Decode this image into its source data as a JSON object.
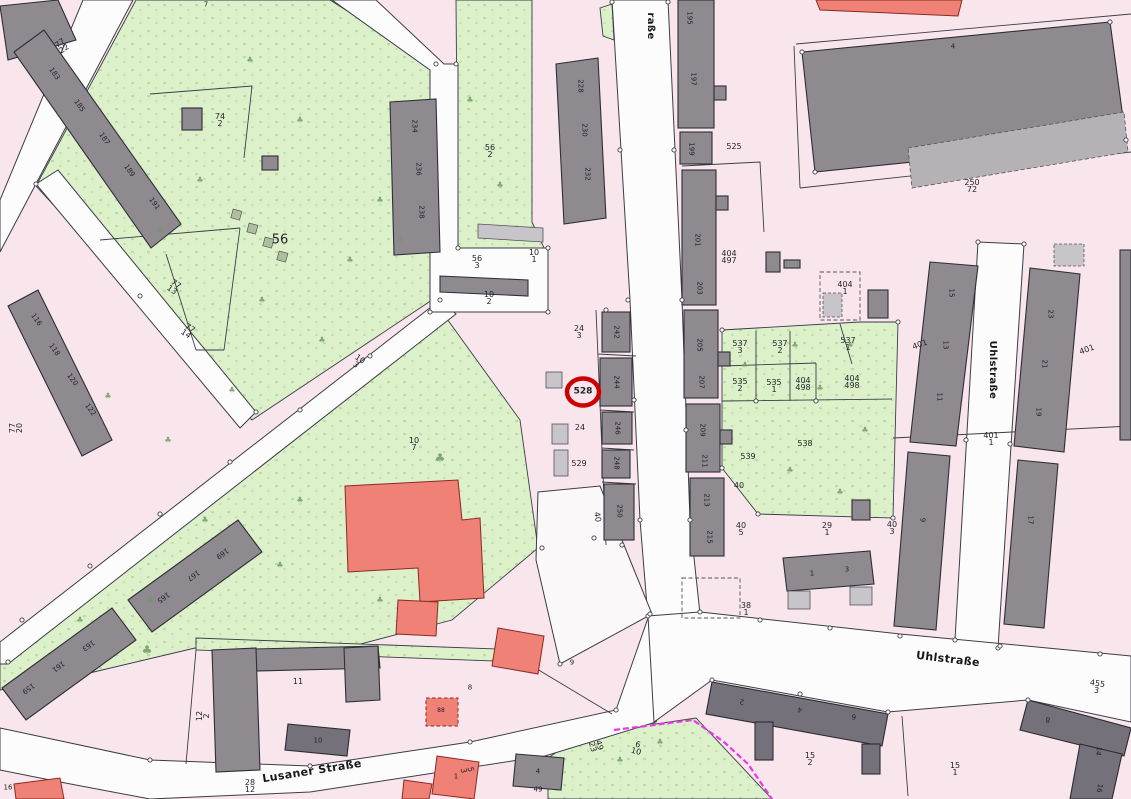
{
  "map": {
    "type": "cadastral-parcel-map",
    "highlighted_parcel": "528",
    "streets": [
      "Uhlstraße",
      "Lusaner Straße"
    ],
    "colors": {
      "parcel_pink": "#f8e6ec",
      "street_white": "#fdfcfd",
      "green_area": "#dcf0ca",
      "building_gray": "#8e8a90",
      "building_dark": "#75717a",
      "building_light": "#c7c4ca",
      "red_building": "#ef8177",
      "highlight_ring": "#cc0000",
      "boundary_magenta": "#e838e8",
      "boundary_line": "#3c3c46"
    },
    "labels": [
      {
        "t": "raße",
        "x": 650,
        "y": 26,
        "r": 90,
        "s": 10,
        "b": 1,
        "cls": "street-label"
      },
      {
        "t": "Uhlstraße",
        "x": 992,
        "y": 370,
        "r": 90,
        "s": 10,
        "b": 1,
        "cls": "street-label"
      },
      {
        "t": "Uhlstraße",
        "x": 948,
        "y": 659,
        "r": 7,
        "s": 11,
        "b": 1,
        "cls": "street-label"
      },
      {
        "t": "Lusaner Straße",
        "x": 312,
        "y": 771,
        "r": -9,
        "s": 11,
        "b": 1,
        "cls": "street-label"
      },
      {
        "t": "528",
        "x": 583,
        "y": 392,
        "s": 9,
        "b": 1,
        "cls": "highlighted-parcel-label"
      },
      {
        "t": "77/22",
        "x": 62,
        "y": 46,
        "r": -35
      },
      {
        "t": "74/2",
        "x": 220,
        "y": 120
      },
      {
        "t": "7",
        "x": 206,
        "y": 5,
        "s": 7
      },
      {
        "t": "56",
        "x": 280,
        "y": 240,
        "s": 13
      },
      {
        "t": "77/13",
        "x": 174,
        "y": 287,
        "r": 35
      },
      {
        "t": "77/14",
        "x": 188,
        "y": 331,
        "r": 35
      },
      {
        "t": "77/20",
        "x": 16,
        "y": 428,
        "r": -90
      },
      {
        "t": "10/3",
        "x": 358,
        "y": 362,
        "r": 35
      },
      {
        "t": "10/7",
        "x": 414,
        "y": 444
      },
      {
        "t": "56/2",
        "x": 490,
        "y": 151
      },
      {
        "t": "56/3",
        "x": 477,
        "y": 262
      },
      {
        "t": "10/1",
        "x": 534,
        "y": 256
      },
      {
        "t": "10/2",
        "x": 489,
        "y": 298
      },
      {
        "t": "24/3",
        "x": 579,
        "y": 332
      },
      {
        "t": "24",
        "x": 580,
        "y": 428
      },
      {
        "t": "529",
        "x": 579,
        "y": 464
      },
      {
        "t": "40",
        "x": 597,
        "y": 517,
        "r": 80
      },
      {
        "t": "525",
        "x": 734,
        "y": 147
      },
      {
        "t": "404/497",
        "x": 729,
        "y": 257
      },
      {
        "t": "404/1",
        "x": 845,
        "y": 288
      },
      {
        "t": "537/3",
        "x": 740,
        "y": 347
      },
      {
        "t": "537/2",
        "x": 780,
        "y": 347
      },
      {
        "t": "537/1",
        "x": 848,
        "y": 344
      },
      {
        "t": "535/2",
        "x": 740,
        "y": 385
      },
      {
        "t": "535/1",
        "x": 774,
        "y": 386
      },
      {
        "t": "404/498",
        "x": 803,
        "y": 384
      },
      {
        "t": "404/498",
        "x": 852,
        "y": 382
      },
      {
        "t": "538",
        "x": 805,
        "y": 444
      },
      {
        "t": "539",
        "x": 748,
        "y": 457
      },
      {
        "t": "40",
        "x": 739,
        "y": 486
      },
      {
        "t": "40/5",
        "x": 741,
        "y": 529
      },
      {
        "t": "29/1",
        "x": 827,
        "y": 529
      },
      {
        "t": "40/3",
        "x": 892,
        "y": 528
      },
      {
        "t": "38/1",
        "x": 746,
        "y": 609
      },
      {
        "t": "250/72",
        "x": 972,
        "y": 186
      },
      {
        "t": "4",
        "x": 953,
        "y": 47,
        "s": 7
      },
      {
        "t": "401",
        "x": 920,
        "y": 345,
        "r": -20
      },
      {
        "t": "401",
        "x": 1087,
        "y": 350,
        "r": -20
      },
      {
        "t": "401/1",
        "x": 991,
        "y": 439
      },
      {
        "t": "455/3",
        "x": 1097,
        "y": 687,
        "r": 8
      },
      {
        "t": "15/2",
        "x": 810,
        "y": 759
      },
      {
        "t": "15/1",
        "x": 955,
        "y": 769
      },
      {
        "t": "16",
        "x": 8,
        "y": 788,
        "s": 7
      },
      {
        "t": "12/2",
        "x": 203,
        "y": 716,
        "r": -90
      },
      {
        "t": "28/12",
        "x": 250,
        "y": 786
      },
      {
        "t": "11",
        "x": 298,
        "y": 682
      },
      {
        "t": "8",
        "x": 470,
        "y": 688,
        "s": 7
      },
      {
        "t": "9",
        "x": 572,
        "y": 663,
        "s": 7
      },
      {
        "t": "5/3",
        "x": 467,
        "y": 770,
        "r": 80
      },
      {
        "t": "49/23",
        "x": 596,
        "y": 746,
        "r": 75
      },
      {
        "t": "6/10",
        "x": 637,
        "y": 748,
        "r": 15
      },
      {
        "t": "49",
        "x": 538,
        "y": 790,
        "s": 7
      },
      {
        "t": "183",
        "x": 54,
        "y": 74,
        "r": 55,
        "s": 7,
        "cls": "house-number"
      },
      {
        "t": "185",
        "x": 79,
        "y": 106,
        "r": 55,
        "s": 7,
        "cls": "house-number"
      },
      {
        "t": "187",
        "x": 104,
        "y": 139,
        "r": 55,
        "s": 7,
        "cls": "house-number"
      },
      {
        "t": "189",
        "x": 129,
        "y": 171,
        "r": 55,
        "s": 7,
        "cls": "house-number"
      },
      {
        "t": "191",
        "x": 154,
        "y": 204,
        "r": 55,
        "s": 7,
        "cls": "house-number"
      },
      {
        "t": "116",
        "x": 36,
        "y": 320,
        "r": 55,
        "s": 7,
        "cls": "house-number"
      },
      {
        "t": "118",
        "x": 54,
        "y": 350,
        "r": 55,
        "s": 7,
        "cls": "house-number"
      },
      {
        "t": "120",
        "x": 72,
        "y": 380,
        "r": 55,
        "s": 7,
        "cls": "house-number"
      },
      {
        "t": "122",
        "x": 90,
        "y": 410,
        "r": 55,
        "s": 7,
        "cls": "house-number"
      },
      {
        "t": "165",
        "x": 163,
        "y": 597,
        "r": 144,
        "s": 7,
        "cls": "house-number"
      },
      {
        "t": "167",
        "x": 193,
        "y": 575,
        "r": 144,
        "s": 7,
        "cls": "house-number"
      },
      {
        "t": "169",
        "x": 222,
        "y": 553,
        "r": 144,
        "s": 7,
        "cls": "house-number"
      },
      {
        "t": "159",
        "x": 28,
        "y": 688,
        "r": 144,
        "s": 7,
        "cls": "house-number"
      },
      {
        "t": "161",
        "x": 58,
        "y": 666,
        "r": 144,
        "s": 7,
        "cls": "house-number"
      },
      {
        "t": "163",
        "x": 88,
        "y": 645,
        "r": 144,
        "s": 7,
        "cls": "house-number"
      },
      {
        "t": "234",
        "x": 414,
        "y": 126,
        "r": 90,
        "s": 7,
        "cls": "house-number"
      },
      {
        "t": "236",
        "x": 418,
        "y": 169,
        "r": 90,
        "s": 7,
        "cls": "house-number"
      },
      {
        "t": "238",
        "x": 421,
        "y": 212,
        "r": 90,
        "s": 7,
        "cls": "house-number"
      },
      {
        "t": "228",
        "x": 580,
        "y": 86,
        "r": 90,
        "s": 7,
        "cls": "house-number"
      },
      {
        "t": "230",
        "x": 584,
        "y": 130,
        "r": 90,
        "s": 7,
        "cls": "house-number"
      },
      {
        "t": "232",
        "x": 587,
        "y": 174,
        "r": 90,
        "s": 7,
        "cls": "house-number"
      },
      {
        "t": "195",
        "x": 689,
        "y": 18,
        "r": 90,
        "s": 7,
        "cls": "house-number"
      },
      {
        "t": "197",
        "x": 693,
        "y": 79,
        "r": 90,
        "s": 7,
        "cls": "house-number"
      },
      {
        "t": "199",
        "x": 691,
        "y": 149,
        "r": 90,
        "s": 7,
        "cls": "house-number"
      },
      {
        "t": "201",
        "x": 697,
        "y": 240,
        "r": 90,
        "s": 7,
        "cls": "house-number"
      },
      {
        "t": "203",
        "x": 699,
        "y": 288,
        "r": 90,
        "s": 7,
        "cls": "house-number"
      },
      {
        "t": "205",
        "x": 699,
        "y": 345,
        "r": 90,
        "s": 7,
        "cls": "house-number"
      },
      {
        "t": "207",
        "x": 701,
        "y": 382,
        "r": 90,
        "s": 7,
        "cls": "house-number"
      },
      {
        "t": "209",
        "x": 702,
        "y": 430,
        "r": 90,
        "s": 7,
        "cls": "house-number"
      },
      {
        "t": "211",
        "x": 704,
        "y": 461,
        "r": 90,
        "s": 7,
        "cls": "house-number"
      },
      {
        "t": "213",
        "x": 706,
        "y": 500,
        "r": 90,
        "s": 7,
        "cls": "house-number"
      },
      {
        "t": "215",
        "x": 709,
        "y": 537,
        "r": 90,
        "s": 7,
        "cls": "house-number"
      },
      {
        "t": "242",
        "x": 616,
        "y": 332,
        "r": 90,
        "s": 7,
        "cls": "house-number"
      },
      {
        "t": "244",
        "x": 616,
        "y": 382,
        "r": 90,
        "s": 7,
        "cls": "house-number"
      },
      {
        "t": "246",
        "x": 617,
        "y": 428,
        "r": 90,
        "s": 7,
        "cls": "house-number"
      },
      {
        "t": "248",
        "x": 616,
        "y": 463,
        "r": 90,
        "s": 7,
        "cls": "house-number"
      },
      {
        "t": "250",
        "x": 619,
        "y": 511,
        "r": 90,
        "s": 7,
        "cls": "house-number"
      },
      {
        "t": "15",
        "x": 951,
        "y": 293,
        "r": 90,
        "s": 7,
        "cls": "house-number"
      },
      {
        "t": "13",
        "x": 945,
        "y": 345,
        "r": 90,
        "s": 7,
        "cls": "house-number"
      },
      {
        "t": "11",
        "x": 939,
        "y": 397,
        "r": 90,
        "s": 7,
        "cls": "house-number"
      },
      {
        "t": "9",
        "x": 922,
        "y": 520,
        "r": 90,
        "s": 7,
        "cls": "house-number"
      },
      {
        "t": "23",
        "x": 1050,
        "y": 314,
        "r": 90,
        "s": 7,
        "cls": "house-number"
      },
      {
        "t": "21",
        "x": 1044,
        "y": 364,
        "r": 90,
        "s": 7,
        "cls": "house-number"
      },
      {
        "t": "19",
        "x": 1038,
        "y": 412,
        "r": 90,
        "s": 7,
        "cls": "house-number"
      },
      {
        "t": "17",
        "x": 1030,
        "y": 520,
        "r": 90,
        "s": 7,
        "cls": "house-number"
      },
      {
        "t": "2",
        "x": 742,
        "y": 701,
        "r": 188,
        "s": 7,
        "cls": "house-number"
      },
      {
        "t": "4",
        "x": 800,
        "y": 709,
        "r": 188,
        "s": 7,
        "cls": "house-number"
      },
      {
        "t": "6",
        "x": 854,
        "y": 716,
        "r": 188,
        "s": 7,
        "cls": "house-number"
      },
      {
        "t": "8",
        "x": 1048,
        "y": 719,
        "r": 188,
        "s": 7,
        "cls": "house-number"
      },
      {
        "t": "14",
        "x": 1098,
        "y": 751,
        "r": 100,
        "s": 7,
        "cls": "house-number"
      },
      {
        "t": "16",
        "x": 1099,
        "y": 788,
        "r": 100,
        "s": 7,
        "cls": "house-number"
      },
      {
        "t": "1",
        "x": 812,
        "y": 574,
        "s": 7,
        "cls": "house-number"
      },
      {
        "t": "3",
        "x": 847,
        "y": 570,
        "s": 7,
        "cls": "house-number"
      },
      {
        "t": "10",
        "x": 318,
        "y": 741,
        "s": 7,
        "cls": "house-number"
      },
      {
        "t": "4",
        "x": 538,
        "y": 772,
        "s": 7,
        "cls": "house-number"
      },
      {
        "t": "88",
        "x": 441,
        "y": 711,
        "s": 6,
        "cls": "house-number"
      },
      {
        "t": "1",
        "x": 456,
        "y": 777,
        "s": 7,
        "cls": "house-number"
      }
    ]
  }
}
